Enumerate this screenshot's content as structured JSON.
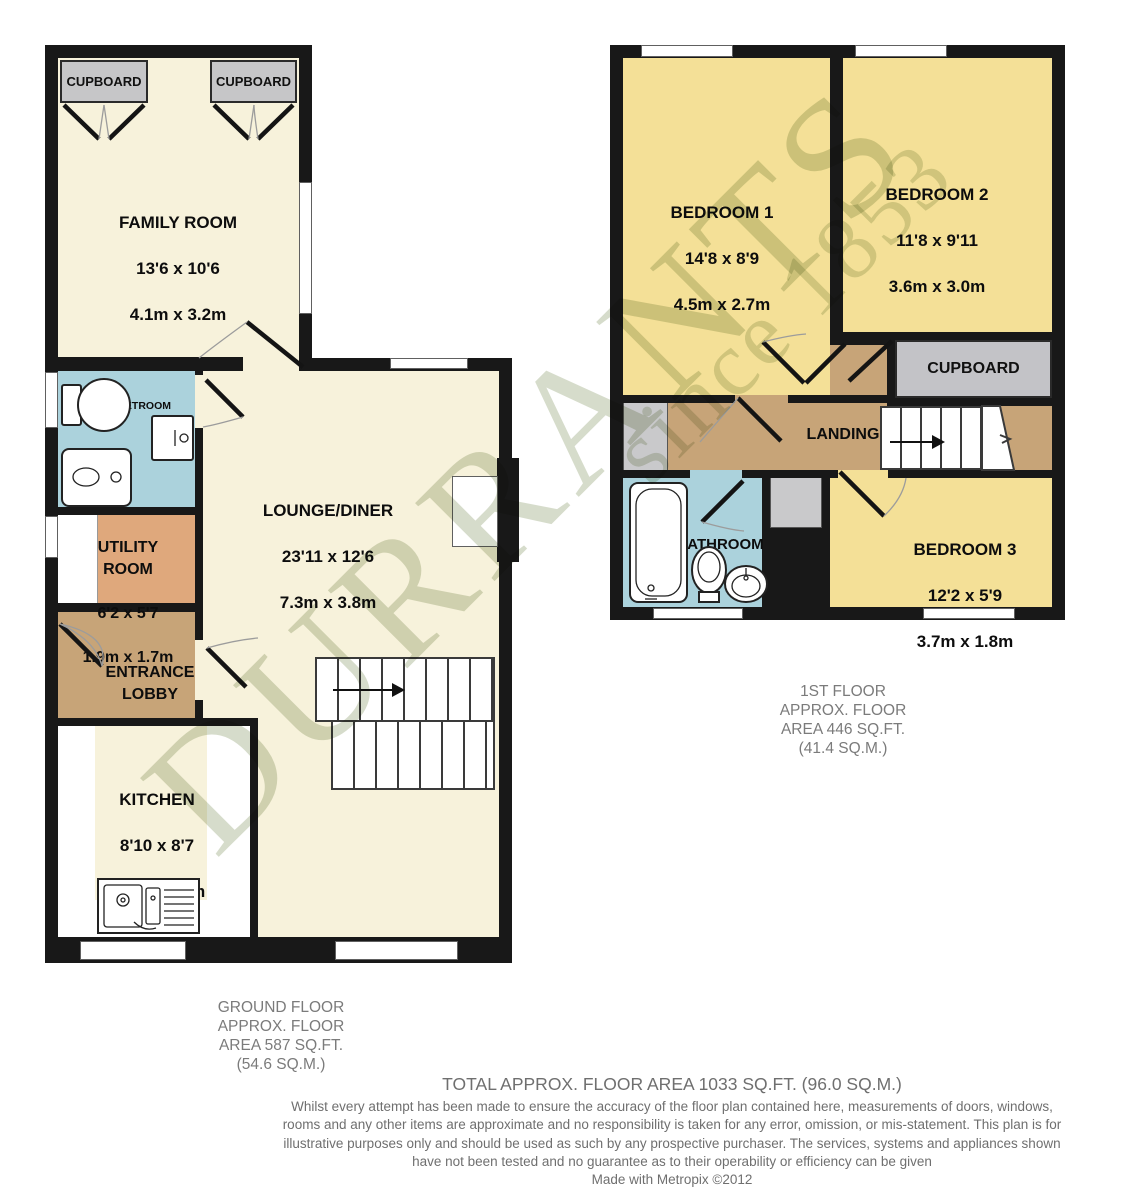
{
  "watermark": {
    "text": "DURRANTS",
    "tagline": "since 1853"
  },
  "ground_floor": {
    "cupboard_left": "CUPBOARD",
    "cupboard_right": "CUPBOARD",
    "family_room": {
      "name": "FAMILY ROOM",
      "imperial": "13'6 x 10'6",
      "metric": "4.1m x 3.2m"
    },
    "wetroom": {
      "name": "WETROOM"
    },
    "utility": {
      "name": "UTILITY ROOM",
      "imperial": "6'2 x 5'7",
      "metric": "1.9m x 1.7m"
    },
    "lobby": {
      "name": "ENTRANCE LOBBY"
    },
    "kitchen": {
      "name": "KITCHEN",
      "imperial": "8'10 x 8'7",
      "metric": "2.7m x 2.6m"
    },
    "lounge": {
      "name": "LOUNGE/DINER",
      "imperial": "23'11 x 12'6",
      "metric": "7.3m x 3.8m"
    },
    "caption": [
      "GROUND FLOOR",
      "APPROX. FLOOR",
      "AREA 587 SQ.FT.",
      "(54.6 SQ.M.)"
    ]
  },
  "first_floor": {
    "bedroom1": {
      "name": "BEDROOM 1",
      "imperial": "14'8 x 8'9",
      "metric": "4.5m x 2.7m"
    },
    "bedroom2": {
      "name": "BEDROOM 2",
      "imperial": "11'8 x 9'11",
      "metric": "3.6m x 3.0m"
    },
    "cupboard": "CUPBOARD",
    "landing": "LANDING",
    "bathroom": "BATHROOM",
    "bedroom3": {
      "name": "BEDROOM 3",
      "imperial": "12'2 x 5'9",
      "metric": "3.7m x 1.8m"
    },
    "caption": [
      "1ST FLOOR",
      "APPROX. FLOOR",
      "AREA 446 SQ.FT.",
      "(41.4 SQ.M.)"
    ]
  },
  "footer": {
    "total": "TOTAL APPROX. FLOOR AREA 1033 SQ.FT. (96.0 SQ.M.)",
    "disclaimer": "Whilst every attempt has been made to ensure the accuracy of the floor plan contained here, measurements of doors, windows, rooms and any other items are approximate and no responsibility is taken for any error, omission, or mis-statement. This plan is for illustrative purposes only and should be used as such by any prospective purchaser. The services, systems and appliances shown have not been tested and no guarantee as to their operability or efficiency can be given",
    "credit": "Made with Metropix ©2012"
  },
  "colors": {
    "wall": "#181818",
    "ground_room": "#f7f2db",
    "first_room": "#f4e097",
    "wet_blue": "#abd2dc",
    "utility_orange": "#dfa87c",
    "hall_brown": "#c7a478",
    "cupboard_gray": "#c6c6c8",
    "watermark_green": "#94a476"
  }
}
